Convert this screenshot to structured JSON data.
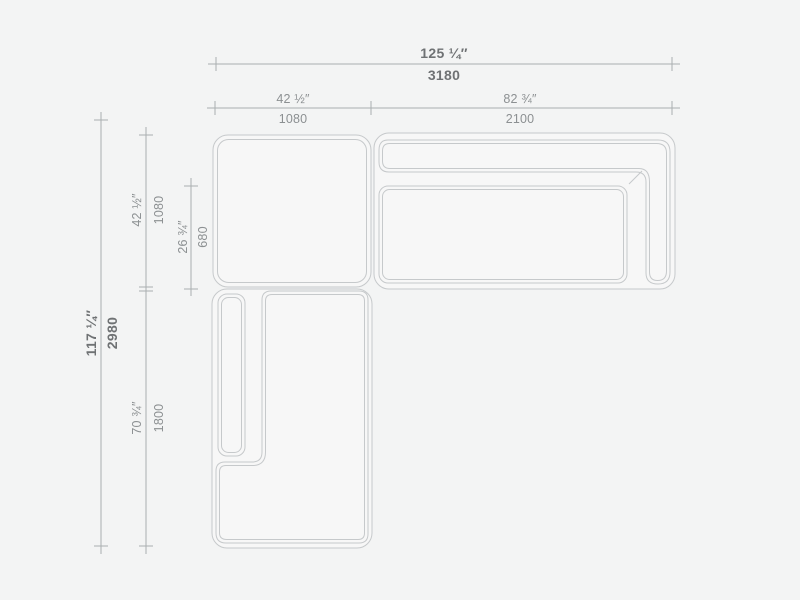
{
  "page": {
    "background": "#f3f4f4"
  },
  "drawing": {
    "name": "sectional-sofa-plan-view-with-dimensions",
    "colors": {
      "furniture_line": "#c6c9cb",
      "furniture_fill": "#f7f7f7",
      "dimension_line": "#a9aeb0",
      "text_primary": "#6f7274",
      "text_secondary": "#8c9092"
    },
    "dimensions": {
      "overall_width": {
        "inches": "125 ¼″",
        "mm": "3180"
      },
      "left_section_width": {
        "inches": "42 ½″",
        "mm": "1080"
      },
      "right_section_width": {
        "inches": "82 ¾″",
        "mm": "2100"
      },
      "overall_depth": {
        "inches": "117 ¼″",
        "mm": "2980"
      },
      "top_section_depth": {
        "inches": "42 ½″",
        "mm": "1080"
      },
      "seat_depth": {
        "inches": "26 ¾″",
        "mm": "680"
      },
      "chaise_length": {
        "inches": "70 ¾″",
        "mm": "1800"
      }
    }
  }
}
